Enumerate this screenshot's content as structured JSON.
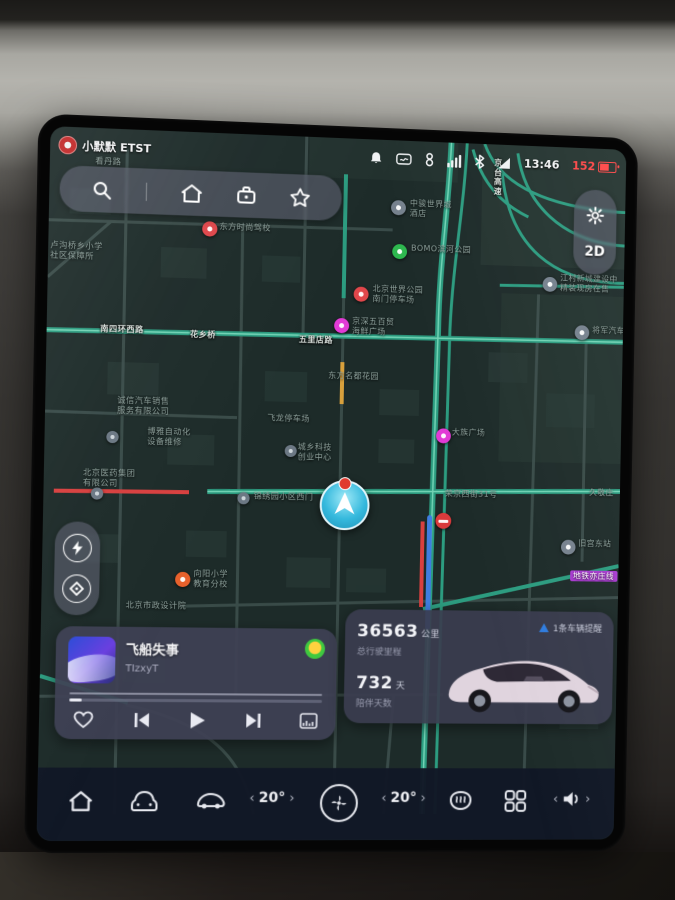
{
  "status_bar": {
    "badge_text": "小默默 ETST",
    "time": "13:46",
    "range_km": "152"
  },
  "map_controls": {
    "view_mode": "2D"
  },
  "music_player": {
    "title": "飞船失事",
    "artist": "TIzxyT",
    "source": "qq-music",
    "progress_percent": 5
  },
  "vehicle_card": {
    "odometer_value": "36563",
    "odometer_unit": "公里",
    "odometer_caption": "总行驶里程",
    "companion_value": "732",
    "companion_unit": "天",
    "companion_caption": "陪伴天数",
    "alert_text": "1条车辆提醒"
  },
  "dock": {
    "driver_temp": "20°",
    "passenger_temp": "20°"
  },
  "map": {
    "labels": [
      {
        "x": 44,
        "y": 28,
        "style": "poi",
        "lines": [
          "看丹路"
        ]
      },
      {
        "x": 2,
        "y": 112,
        "style": "poi",
        "lines": [
          "卢沟桥乡小学",
          "社区保障所"
        ]
      },
      {
        "x": 167,
        "y": 88,
        "style": "poi",
        "lines": [
          "东方时尚驾校"
        ]
      },
      {
        "x": 357,
        "y": 58,
        "style": "poi",
        "lines": [
          "中骏世界城",
          "酒店"
        ]
      },
      {
        "x": 359,
        "y": 103,
        "style": "poi",
        "lines": [
          "BOMO滨河公园"
        ]
      },
      {
        "x": 321,
        "y": 145,
        "style": "poi",
        "lines": [
          "北京世界公园",
          "南门停车场"
        ]
      },
      {
        "x": 301,
        "y": 178,
        "style": "poi",
        "lines": [
          "京深五百贸",
          "海鲜广场"
        ]
      },
      {
        "x": 52,
        "y": 193,
        "style": "road",
        "lines": [
          "南四环西路"
        ]
      },
      {
        "x": 140,
        "y": 196,
        "style": "road",
        "lines": [
          "花乡桥"
        ]
      },
      {
        "x": 248,
        "y": 198,
        "style": "road",
        "lines": [
          "五里店路"
        ]
      },
      {
        "x": 442,
        "y": 14,
        "style": "road",
        "lines": [
          "京",
          "台",
          "高",
          "速"
        ]
      },
      {
        "x": 70,
        "y": 263,
        "style": "poi",
        "lines": [
          "诚信汽车销售",
          "服务有限公司"
        ]
      },
      {
        "x": 100,
        "y": 293,
        "style": "poi",
        "lines": [
          "博雅自动化",
          "设备维修"
        ]
      },
      {
        "x": 38,
        "y": 335,
        "style": "poi",
        "lines": [
          "北京医药集团",
          "有限公司"
        ]
      },
      {
        "x": 278,
        "y": 233,
        "style": "poi",
        "lines": [
          "东方名都花园"
        ]
      },
      {
        "x": 218,
        "y": 277,
        "style": "poi",
        "lines": [
          "飞龙停车场"
        ]
      },
      {
        "x": 206,
        "y": 355,
        "style": "poi",
        "lines": [
          "锦绣园小区西门"
        ]
      },
      {
        "x": 398,
        "y": 349,
        "style": "poi",
        "lines": [
          "荣京西街31号"
        ]
      },
      {
        "x": 404,
        "y": 287,
        "style": "poi",
        "lines": [
          "大族广场"
        ]
      },
      {
        "x": 249,
        "y": 305,
        "style": "poi",
        "lines": [
          "城乡科技",
          "创业中心"
        ]
      },
      {
        "x": 512,
        "y": 128,
        "style": "poi",
        "lines": [
          "江村新城建设中",
          "精装现房在售"
        ]
      },
      {
        "x": 546,
        "y": 180,
        "style": "poi",
        "lines": [
          "将军汽车"
        ]
      },
      {
        "x": 546,
        "y": 345,
        "style": "poi",
        "lines": [
          "久敬庄"
        ]
      },
      {
        "x": 536,
        "y": 397,
        "style": "poi",
        "lines": [
          "旧宫东站"
        ]
      },
      {
        "x": 528,
        "y": 429,
        "style": "metro",
        "lines": [
          "地铁亦庄线"
        ]
      },
      {
        "x": 148,
        "y": 433,
        "style": "poi",
        "lines": [
          "向阳小学",
          "教育分校"
        ]
      },
      {
        "x": 82,
        "y": 465,
        "style": "poi",
        "lines": [
          "北京市政设计院"
        ]
      }
    ],
    "markers": [
      {
        "x": 150,
        "y": 88,
        "type": "red"
      },
      {
        "x": 338,
        "y": 60,
        "type": "grey"
      },
      {
        "x": 340,
        "y": 104,
        "type": "green"
      },
      {
        "x": 302,
        "y": 148,
        "type": "red"
      },
      {
        "x": 283,
        "y": 180,
        "type": "magenta"
      },
      {
        "x": 494,
        "y": 132,
        "type": "grey"
      },
      {
        "x": 528,
        "y": 180,
        "type": "grey"
      },
      {
        "x": 388,
        "y": 288,
        "type": "magenta"
      },
      {
        "x": 130,
        "y": 436,
        "type": "orange"
      },
      {
        "x": 518,
        "y": 398,
        "type": "grey"
      },
      {
        "x": 190,
        "y": 356,
        "type": "greydot"
      },
      {
        "x": 60,
        "y": 298,
        "type": "greydot"
      },
      {
        "x": 236,
        "y": 308,
        "type": "greydot"
      },
      {
        "x": 46,
        "y": 354,
        "type": "greydot"
      },
      {
        "x": 389,
        "y": 373,
        "type": "noentry"
      }
    ]
  }
}
